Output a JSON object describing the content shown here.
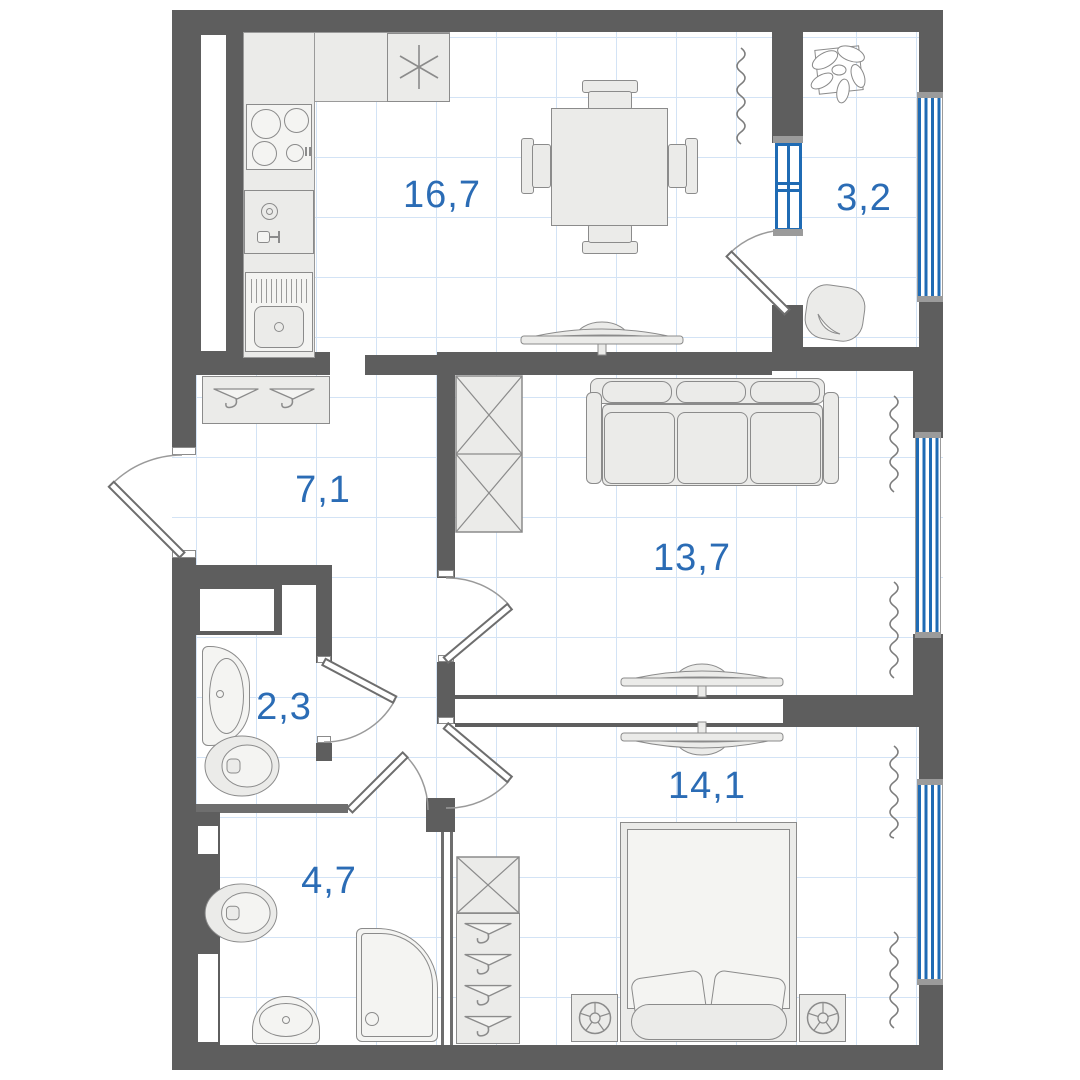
{
  "floorplan": {
    "type": "apartment-floor-plan",
    "rooms": [
      {
        "id": "kitchen-living-room",
        "area_label": "16,7"
      },
      {
        "id": "balcony",
        "area_label": "3,2"
      },
      {
        "id": "hallway",
        "area_label": "7,1"
      },
      {
        "id": "living-room",
        "area_label": "13,7"
      },
      {
        "id": "wc",
        "area_label": "2,3"
      },
      {
        "id": "bathroom",
        "area_label": "4,7"
      },
      {
        "id": "bedroom",
        "area_label": "14,1"
      }
    ],
    "furniture_symbols": [
      "kitchen-counter",
      "fridge",
      "stove",
      "kitchen-sink",
      "washing-machine",
      "dining-table",
      "chair",
      "coat-hanger-rack",
      "wardrobe",
      "sofa",
      "tv",
      "bed",
      "nightstand",
      "lamp",
      "toilet",
      "washbasin",
      "shower-cabin",
      "houseplant",
      "armchair",
      "curtain",
      "window",
      "door"
    ],
    "colors": {
      "wall": "#5e5e5e",
      "window_blue": "#1f6bb4",
      "label_blue": "#2b6cb5",
      "furniture_fill": "#ebebe9",
      "furniture_stroke": "#8b8b8b",
      "grid_line": "#d3e3f5"
    }
  }
}
